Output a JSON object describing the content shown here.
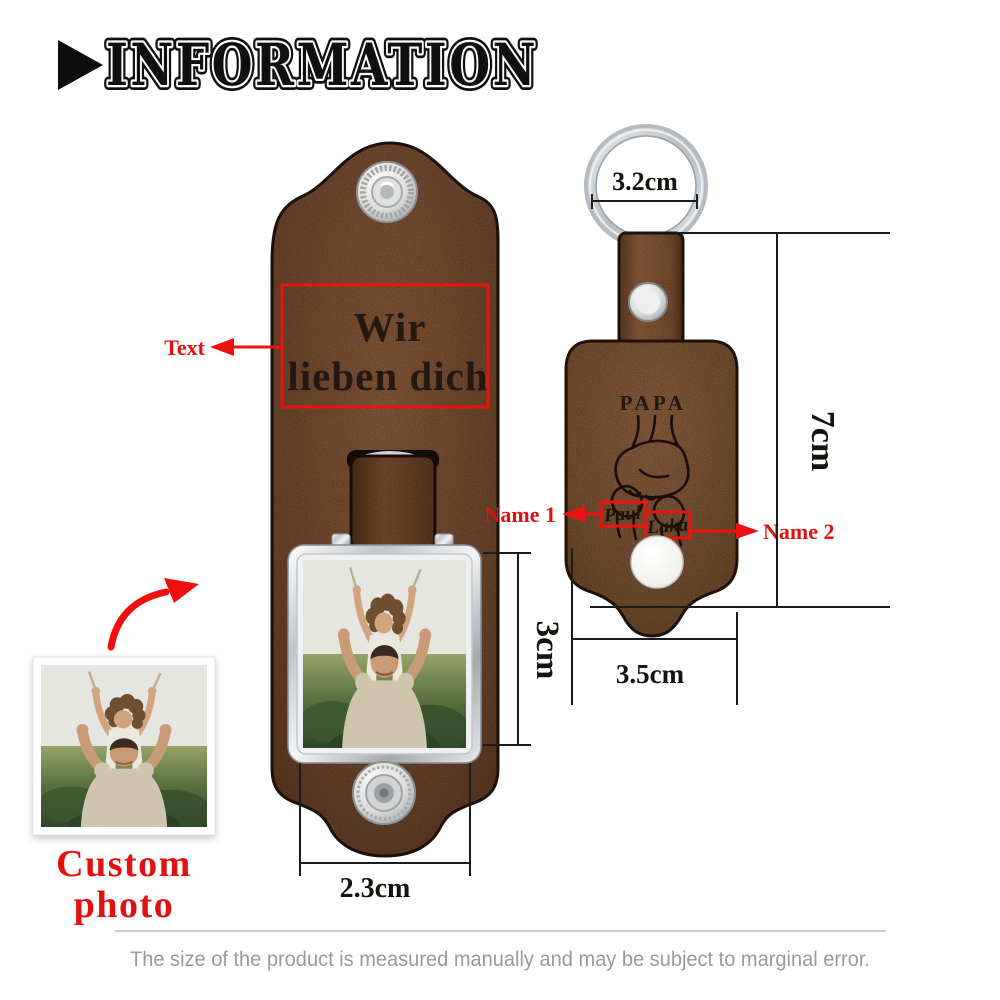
{
  "header": {
    "title": "INFORMATION"
  },
  "left_keychain": {
    "engraving_line1": "Wir",
    "engraving_line2": "lieben dich",
    "text_label": "Text",
    "dim_photo_height": "3cm",
    "dim_width": "2.3cm"
  },
  "right_keychain": {
    "engraved_title": "PAPA",
    "engraved_name1": "Paul",
    "engraved_name2": "Luka",
    "name1_label": "Name 1",
    "name2_label": "Name 2",
    "dim_ring": "3.2cm",
    "dim_height": "7cm",
    "dim_width": "3.5cm"
  },
  "custom_photo": {
    "label_line1": "Custom",
    "label_line2": "photo"
  },
  "footer": {
    "disclaimer": "The size of the product is measured manually and may be subject to marginal error."
  },
  "colors": {
    "accent_red": "#ee1111",
    "leather_left": "#6f482e",
    "leather_right": "#7b5334",
    "metal_silver": "#cfd3d6",
    "title_black": "#101010",
    "disclaimer_gray": "#9a9a9a"
  }
}
